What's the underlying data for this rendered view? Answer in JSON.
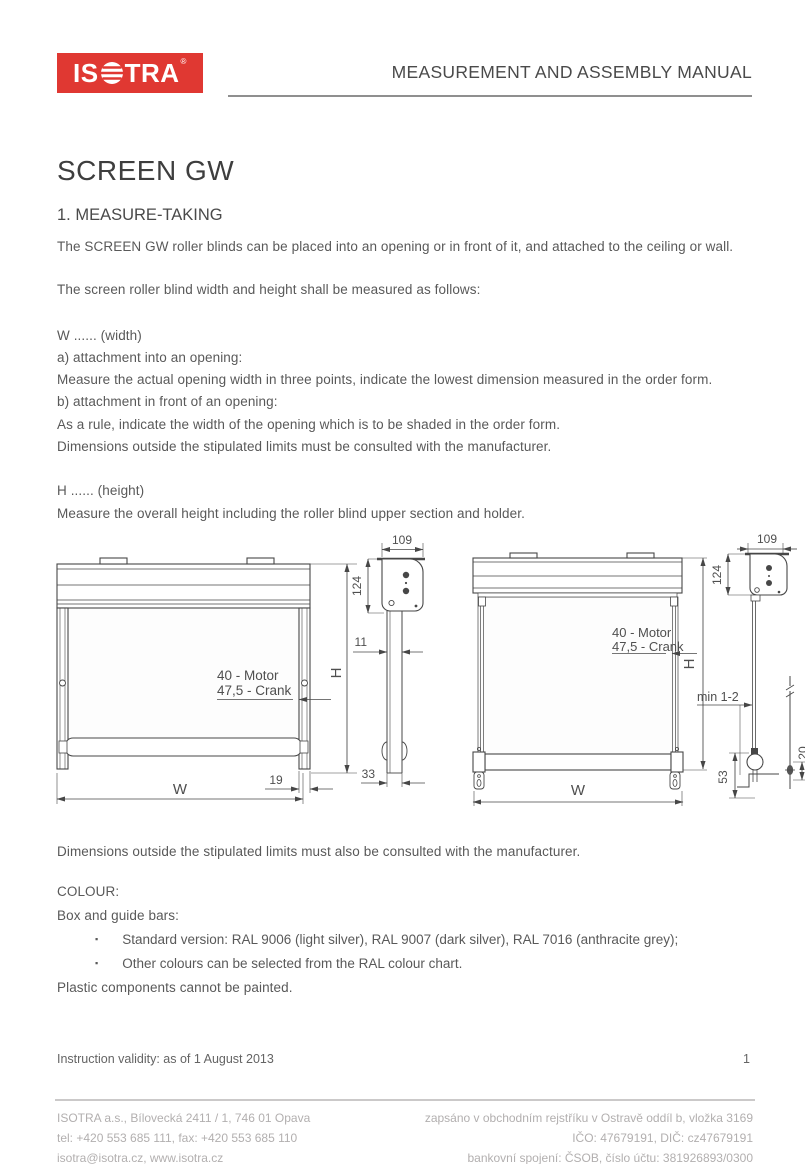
{
  "colors": {
    "brand_red": "#E03832",
    "body_text_gray": "#595959",
    "heading_gray": "#3e3e3e",
    "drawing_line_gray": "#474747",
    "footer_gray": "#b2afaf"
  },
  "header": {
    "logo": {
      "prefix": "IS",
      "suffix": "TRA",
      "registered": "®"
    },
    "title": "MEASUREMENT AND ASSEMBLY MANUAL"
  },
  "doc": {
    "title": "SCREEN GW",
    "section_heading": "1. MEASURE-TAKING",
    "intro1": "The SCREEN GW roller blinds can be placed into an opening or in front of it, and attached to the ceiling or wall.",
    "intro2": "The screen roller blind width and height shall be measured as follows:",
    "width_block": {
      "heading": "W ...... (width)",
      "a_label": "a) attachment into an opening:",
      "a_text": "Measure the actual opening width in three points, indicate the lowest dimension measured in the order form.",
      "b_label": "b) attachment in front of an opening:",
      "b_text": "As a rule, indicate the width of the opening which is to be shaded in the order form.",
      "note": "Dimensions outside the stipulated limits must be consulted with the manufacturer."
    },
    "height_block": {
      "heading": "H ...... (height)",
      "text": "Measure the overall height including the roller blind upper section and holder."
    },
    "after_note": "Dimensions outside the stipulated limits must also be consulted with the manufacturer.",
    "colour": {
      "heading": "COLOUR:",
      "subheading": "Box and guide bars:",
      "bullet_char": "▪",
      "bullets": [
        "Standard version: RAL 9006 (light silver), RAL 9007 (dark silver), RAL 7016 (anthracite grey);",
        "Other colours can be selected from the RAL colour chart."
      ],
      "note": "Plastic components cannot be painted."
    },
    "validity": "Instruction validity: as of 1 August 2013",
    "page_number": "1"
  },
  "drawing": {
    "labels": {
      "dim_109": "109",
      "dim_124": "124",
      "dim_11": "11",
      "dim_33": "33",
      "dim_19": "19",
      "motor": "40 - Motor",
      "crank": "47,5 - Crank",
      "height": "H",
      "width": "W",
      "min_gap": "min 1-2",
      "dim_53": "53",
      "dim_20": "20"
    }
  },
  "footer": {
    "left_lines": [
      "ISOTRA a.s., Bílovecká 2411 / 1, 746 01 Opava",
      "tel: +420 553 685 111, fax: +420 553 685 110",
      "isotra@isotra.cz, www.isotra.cz"
    ],
    "right_lines": [
      "zapsáno v obchodním rejstříku v Ostravě oddíl b, vložka 3169",
      "IČO: 47679191, DIČ: cz47679191",
      "bankovní spojení: ČSOB, číslo účtu: 381926893/0300"
    ]
  }
}
